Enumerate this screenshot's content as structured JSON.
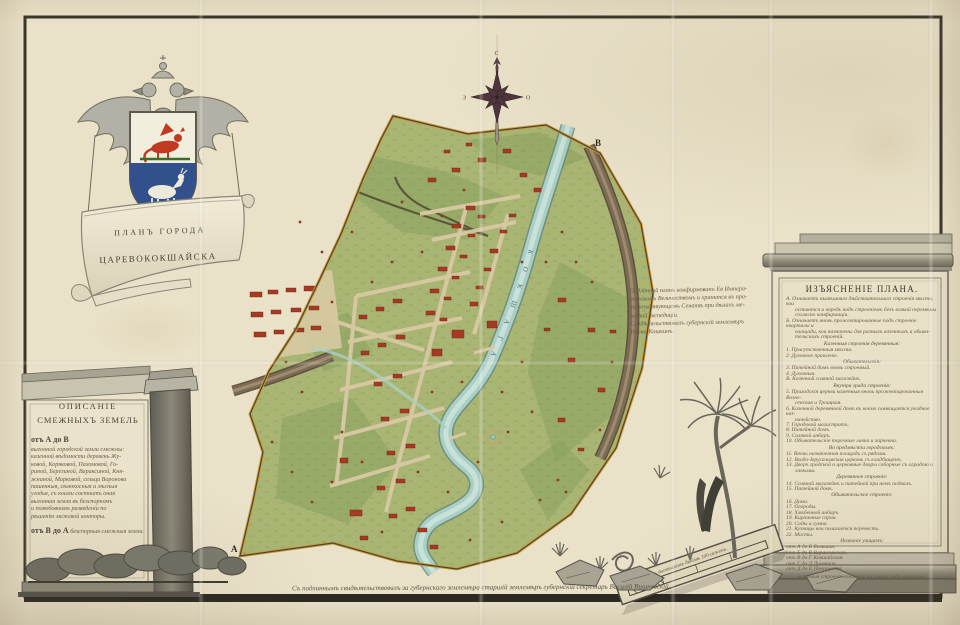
{
  "cartouche": {
    "title_line1": "ПЛАНЪ  ГОРОДА",
    "title_line2": "ЦАРЕВОКОКШАЙСКА"
  },
  "compass": {
    "north": "С",
    "east": "О",
    "west": "З"
  },
  "map": {
    "river_label": "КОКШАГА",
    "letter_top_right": "В",
    "letter_bottom_left": "А"
  },
  "description_panel": {
    "title_line1": "ОПИСАНІЕ",
    "title_line2": "СМЕЖНЫХЪ ЗЕМЕЛЬ",
    "range_label_1": "отъ А до В",
    "lines": [
      "выгонной городской земли смежны:",
      "казенной вѣдомости деревень Жу-",
      "ковой, Коряковой, Пахомовой, Го-",
      "риной, Березиной, Вараксиной, Кня-",
      "жниной, Марковой, сельца Воронова",
      "пашенныя, сѣнокосныя и лѣсныя",
      "угодья, съ коими состоитъ оная",
      "выгонная земля въ безспорномъ",
      "и полюбовномъ разведеніи по",
      "рѣшенію межевой конторы."
    ],
    "range_label_2": "отъ В до А",
    "closing_line": "безспорныя смежныя земли."
  },
  "legend_panel": {
    "title": "ИЗЪЯСНЕНІЕ  ПЛАНА.",
    "lines": [
      {
        "style": "i",
        "text": "А. Означаетъ нынѣшняго дѣйствительнаго строенія мѣста, кои"
      },
      {
        "style": "w",
        "text": "остаются и впредь подъ строеніемъ безъ всякой перемѣны"
      },
      {
        "style": "w",
        "text": "согласно конфирмаціи."
      },
      {
        "style": "i",
        "text": "Б. Означаетъ вновь прожектированные подъ строеніе кварталы и"
      },
      {
        "style": "w",
        "text": "площади, кои назначены для разныхъ казенныхъ и обыва-"
      },
      {
        "style": "w",
        "text": "тельскихъ строеній."
      },
      {
        "style": "h",
        "text": "Казенныя строенія деревянныя:"
      },
      {
        "style": "i",
        "text": "1. Присутственныя мѣста."
      },
      {
        "style": "i",
        "text": "2. Духовное правленіе."
      },
      {
        "style": "h",
        "text": "Обывательскія:"
      },
      {
        "style": "i",
        "text": "3. Питейной домъ вновь строемый."
      },
      {
        "style": "i",
        "text": "4. Духовныя."
      },
      {
        "style": "i",
        "text": "В. Казенной соляной магазейнъ."
      },
      {
        "style": "h",
        "text": "Внутри града строенія:"
      },
      {
        "style": "i",
        "text": "5. Приходскія церкви каменныя вновь прожектированныя Возне-"
      },
      {
        "style": "w",
        "text": "сенская и Троицкая."
      },
      {
        "style": "i",
        "text": "6. Казенной деревянной домъ въ коемъ помѣщается уѣздное каз-"
      },
      {
        "style": "w",
        "text": "начейство."
      },
      {
        "style": "i",
        "text": "7. Городовой магистратъ."
      },
      {
        "style": "i",
        "text": "8. Питейной домъ."
      },
      {
        "style": "i",
        "text": "9. Соляной анбаръ."
      },
      {
        "style": "i",
        "text": "10. Обывательскіе торговые лавки и харчевни."
      },
      {
        "style": "h",
        "text": "Во предмѣстіи городскомъ:"
      },
      {
        "style": "i",
        "text": "11. Вновь назначенная площадь съ рядами."
      },
      {
        "style": "i",
        "text": "12. Входо-Іерусалимская церковь съ кладбищемъ."
      },
      {
        "style": "i",
        "text": "13. Дворъ градской и церковные дворы соборные съ оградою и"
      },
      {
        "style": "w",
        "text": "лавками."
      },
      {
        "style": "h",
        "text": "Деревянное строеніе:"
      },
      {
        "style": "i",
        "text": "14. Соляной магазейнъ и питейной при немъ подвалъ."
      },
      {
        "style": "i",
        "text": "15. Питейной домъ."
      },
      {
        "style": "h",
        "text": "Обывательское строеніе:"
      },
      {
        "style": "i",
        "text": "16. Дома."
      },
      {
        "style": "i",
        "text": "17. Огороды."
      },
      {
        "style": "i",
        "text": "18. Хлѣбенной анбаръ."
      },
      {
        "style": "i",
        "text": "19. Кирпичные сараи."
      },
      {
        "style": "i",
        "text": "20. Сады и гумна."
      },
      {
        "style": "i",
        "text": "21. Кузницы кои полагается перенесть."
      },
      {
        "style": "i",
        "text": "22. Мосты."
      },
      {
        "style": "h",
        "text": "Названіе улицамъ:"
      },
      {
        "style": "i",
        "text": "отъ А до Б  Большая."
      },
      {
        "style": "i",
        "text": "отъ Б до В  Вараксинская."
      },
      {
        "style": "i",
        "text": "отъ В до Г  Кокшайская."
      },
      {
        "style": "i",
        "text": "отъ Г до Д  Дровяная."
      },
      {
        "style": "i",
        "text": "отъ Д до Е  Покровская."
      },
      {
        "style": "hc",
        "text": "всѣ оныя строенія означены на планѣ подъ нумерами."
      }
    ]
  },
  "annotation_note": {
    "lines": [
      "Подлинной планъ конфирмованъ Ея Импера-",
      "торскимъ Величествомъ и хранится въ пра-",
      "вительствующемъ Сенатѣ при дѣлахъ ме-",
      "жевой экспедиціи.",
      "Свидѣтельствовалъ губернскій землемѣръ",
      "Иванъ Кошкинъ."
    ]
  },
  "surveyor_signature": "Съ подлиннымъ свидѣтельствовалъ за губернскаго землемѣра старшій землемѣръ губернскій секретарь Василій Вишневскій.",
  "scale_bar": {
    "label": "Масштабъ въ англинскомъ дюймѣ 100 саженъ."
  },
  "colors": {
    "paper": "#e9e1c8",
    "ink": "#4a4238",
    "faded_ink": "#6b5a46",
    "map_green": "#a9b573",
    "map_green_dark": "#8aa15c",
    "river": "#a9cfc6",
    "road": "#7d6c52",
    "road_dark": "#55473a",
    "building_red": "#a63a24",
    "boundary_band": "#c99a3a",
    "boundary_line": "#4e4632",
    "shield_blue": "#31508c",
    "dragon_red": "#c03a22",
    "compass_dark": "#4e343c"
  }
}
